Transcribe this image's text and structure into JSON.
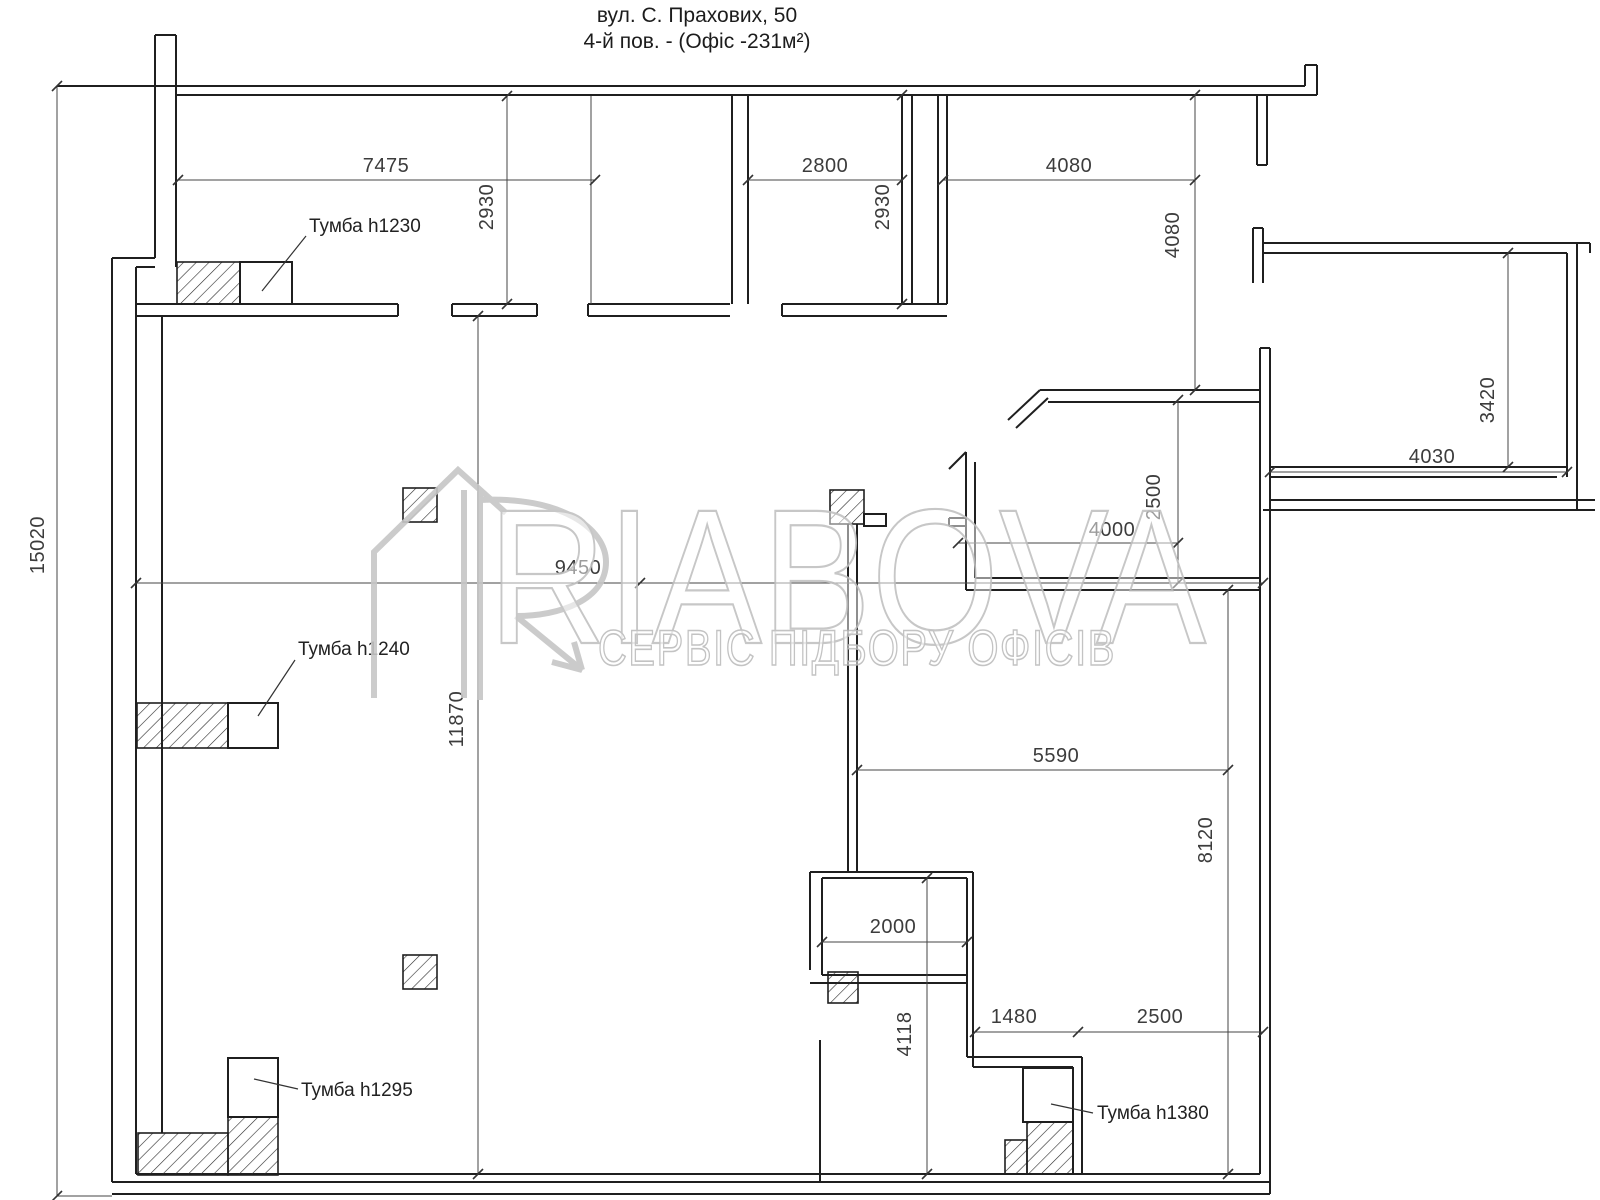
{
  "title": {
    "line1": "вул. С. Прахових, 50",
    "line2": "4-й пов. - (Офіс -231м²)"
  },
  "watermark": {
    "brand": "RIABOVA",
    "tagline": "СЕРВІС ПІДБОРУ ОФІСІВ"
  },
  "furniture_labels": {
    "cabinet_1230": "Тумба h1230",
    "cabinet_1240": "Тумба h1240",
    "cabinet_1295": "Тумба h1295",
    "cabinet_1380": "Тумба h1380"
  },
  "dimensions_mm": {
    "top_left_room_width": "7475",
    "top_middle_room_width": "2800",
    "top_right_span": "4080",
    "top_left_room_depth": "2930",
    "top_middle_room_depth": "2930",
    "right_corridor_depth": "4080",
    "right_room_depth": "3420",
    "right_room_width": "4030",
    "nook_depth": "2500",
    "nook_width": "4000",
    "main_hall_width": "9450",
    "total_height": "15020",
    "left_inner_height": "11870",
    "lower_hall_width": "5590",
    "lower_right_depth": "8120",
    "shaft_width": "2000",
    "shaft_lower_depth": "4118",
    "bottom_nook_width": "1480",
    "bottom_right_width": "2500"
  },
  "colors": {
    "wall_line": "#1f1f1f",
    "dimension_line": "#444444",
    "dimension_text": "#3c3c3c",
    "watermark_outline": "#c1c1c1",
    "background": "#ffffff"
  }
}
